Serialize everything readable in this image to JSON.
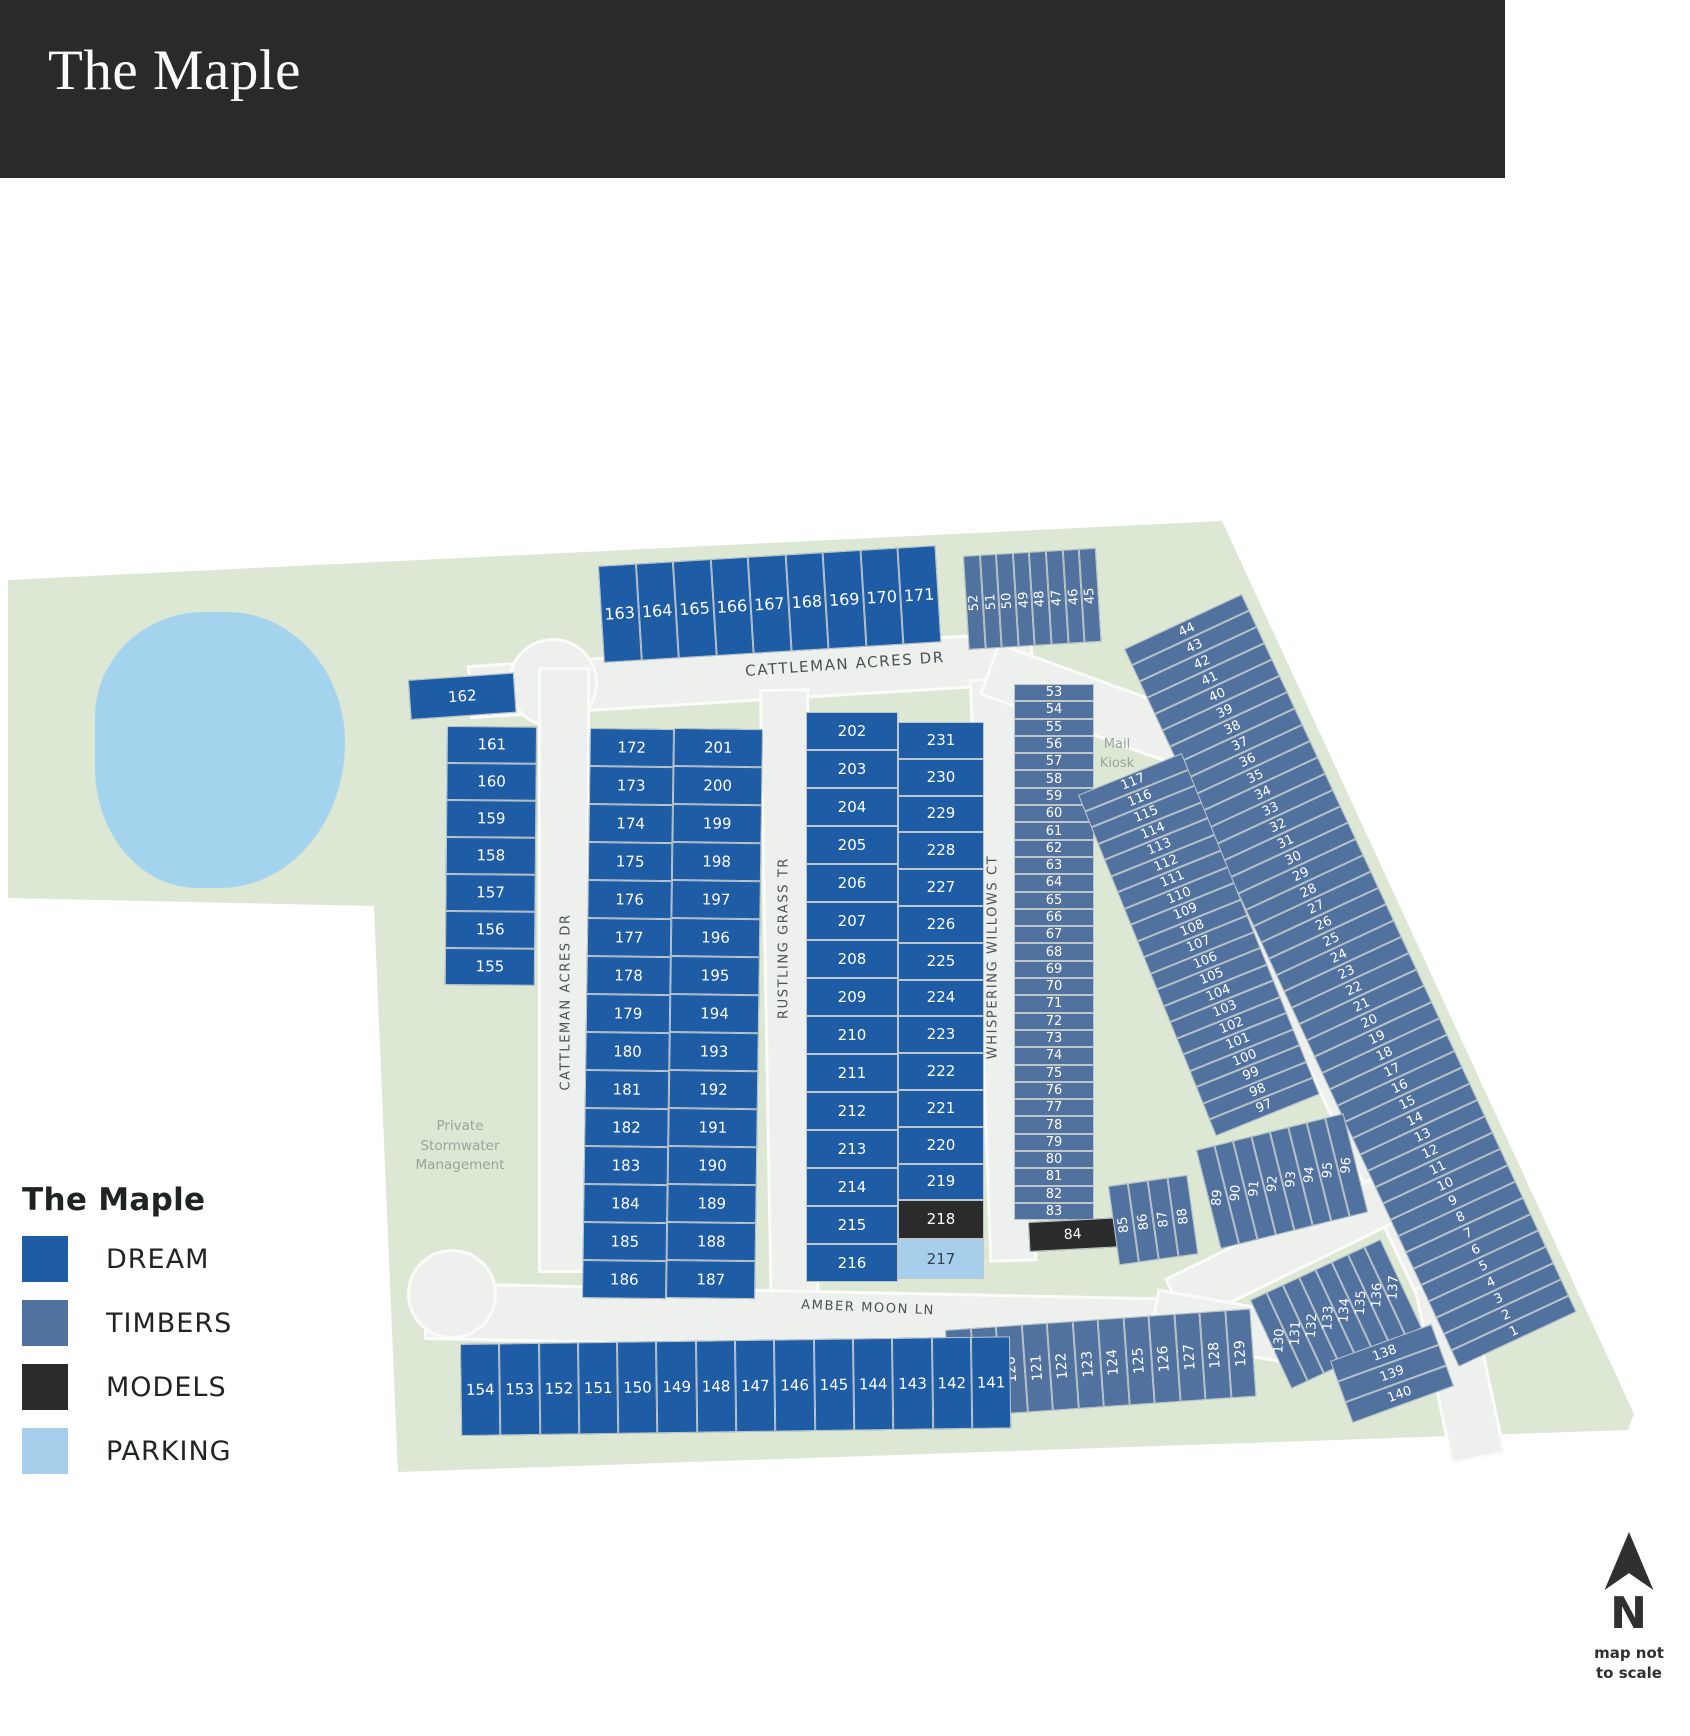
{
  "header": {
    "title": "The Maple"
  },
  "legend": {
    "title": "The Maple",
    "items": [
      {
        "label": "DREAM",
        "category": "dream"
      },
      {
        "label": "TIMBERS",
        "category": "timbers"
      },
      {
        "label": "MODELS",
        "category": "models"
      },
      {
        "label": "PARKING",
        "category": "parking"
      }
    ]
  },
  "north": {
    "label": "N",
    "note_line1": "map not",
    "note_line2": "to scale"
  },
  "map": {
    "colors": {
      "dream": "#1e5ca6",
      "timbers": "#51719e",
      "models": "#2b2b2b",
      "parking": "#a7cfeb",
      "pond": "#a4d3ee",
      "ground": "#dce7d4",
      "road": "#edf0ec"
    },
    "streets": {
      "cattleman_top": "CATTLEMAN ACRES DR",
      "cattleman_left": "CATTLEMAN ACRES DR",
      "cattleman_diag": "CATTLEMAN ACRES DR",
      "rustling": "RUSTLING GRASS TR",
      "whispering": "WHISPERING WILLOWS CT",
      "amber": "AMBER MOON LN"
    },
    "annotations": {
      "stormwater": "Private Stormwater Management",
      "mail_kiosk": "Mail Kiosk"
    },
    "lot_groups": [
      {
        "id": "row-163-171",
        "category": "dream",
        "lots": [
          163,
          164,
          165,
          166,
          167,
          168,
          169,
          170,
          171
        ]
      },
      {
        "id": "row-52-45",
        "category": "timbers",
        "lots": [
          52,
          51,
          50,
          49,
          48,
          47,
          46,
          45
        ]
      },
      {
        "id": "strip-44-1",
        "category": "timbers",
        "lots": [
          44,
          43,
          42,
          41,
          40,
          39,
          38,
          37,
          36,
          35,
          34,
          33,
          32,
          31,
          30,
          29,
          28,
          27,
          26,
          25,
          24,
          23,
          22,
          21,
          20,
          19,
          18,
          17,
          16,
          15,
          14,
          13,
          12,
          11,
          10,
          9,
          8,
          7,
          6,
          5,
          4,
          3,
          2,
          1
        ]
      },
      {
        "id": "col-53-83",
        "category": "timbers",
        "lots": [
          53,
          54,
          55,
          56,
          57,
          58,
          59,
          60,
          61,
          62,
          63,
          64,
          65,
          66,
          67,
          68,
          69,
          70,
          71,
          72,
          73,
          74,
          75,
          76,
          77,
          78,
          79,
          80,
          81,
          82,
          83
        ]
      },
      {
        "id": "lot-84",
        "category": "models",
        "lots": [
          84
        ]
      },
      {
        "id": "col-202-216",
        "category": "dream",
        "lots": [
          202,
          203,
          204,
          205,
          206,
          207,
          208,
          209,
          210,
          211,
          212,
          213,
          214,
          215,
          216
        ]
      },
      {
        "id": "col-231-219",
        "category": "dream",
        "lots": [
          231,
          230,
          229,
          228,
          227,
          226,
          225,
          224,
          223,
          222,
          221,
          220,
          219
        ]
      },
      {
        "id": "lot-218",
        "category": "models",
        "lots": [
          218
        ]
      },
      {
        "id": "lot-217",
        "category": "parking",
        "lots": [
          217
        ]
      },
      {
        "id": "col-172-186",
        "category": "dream",
        "lots": [
          172,
          173,
          174,
          175,
          176,
          177,
          178,
          179,
          180,
          181,
          182,
          183,
          184,
          185,
          186
        ]
      },
      {
        "id": "col-201-187",
        "category": "dream",
        "lots": [
          201,
          200,
          199,
          198,
          197,
          196,
          195,
          194,
          193,
          192,
          191,
          190,
          189,
          188,
          187
        ]
      },
      {
        "id": "lot-162",
        "category": "dream",
        "lots": [
          162
        ]
      },
      {
        "id": "col-161-155",
        "category": "dream",
        "lots": [
          161,
          160,
          159,
          158,
          157,
          156,
          155
        ]
      },
      {
        "id": "strip-117-97",
        "category": "timbers",
        "lots": [
          117,
          116,
          115,
          114,
          113,
          112,
          111,
          110,
          109,
          108,
          107,
          106,
          105,
          104,
          103,
          102,
          101,
          100,
          99,
          98,
          97
        ]
      },
      {
        "id": "row-85-88",
        "category": "timbers",
        "lots": [
          85,
          86,
          87,
          88
        ]
      },
      {
        "id": "row-89-96",
        "category": "timbers",
        "lots": [
          89,
          90,
          91,
          92,
          93,
          94,
          95,
          96
        ]
      },
      {
        "id": "row-118-129",
        "category": "timbers",
        "lots": [
          118,
          119,
          120,
          121,
          122,
          123,
          124,
          125,
          126,
          127,
          128,
          129
        ]
      },
      {
        "id": "row-130-137",
        "category": "timbers",
        "lots": [
          130,
          131,
          132,
          133,
          134,
          135,
          136,
          137
        ]
      },
      {
        "id": "rows-138-140",
        "category": "timbers",
        "lots": [
          138,
          139,
          140
        ]
      },
      {
        "id": "row-154-141",
        "category": "dream",
        "lots": [
          154,
          153,
          152,
          151,
          150,
          149,
          148,
          147,
          146,
          145,
          144,
          143,
          142,
          141
        ]
      }
    ]
  }
}
